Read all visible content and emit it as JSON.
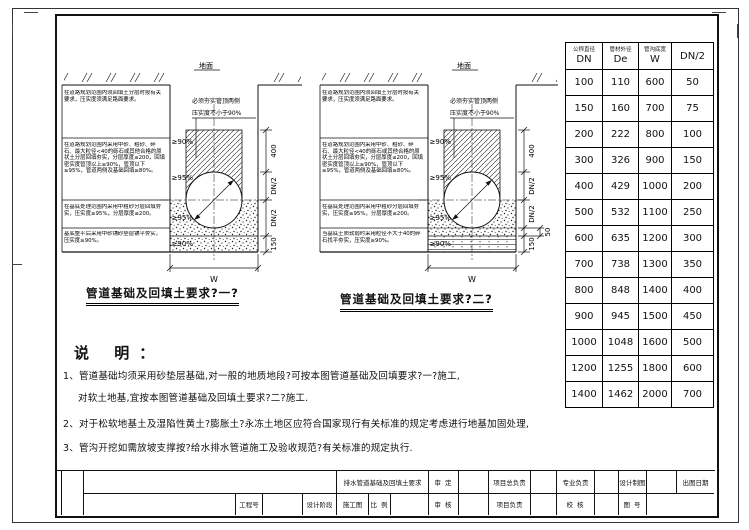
{
  "diagrams": {
    "left": {
      "ground_label": "地面",
      "title": "管道基础及回填土要求?一?",
      "width_label": "W",
      "ann1": "必须夯实管顶两侧",
      "ann2": "压实度不小于90%",
      "blocks": [
        "在道路规划范围内须回填土分层时按有关要求，压实度须满足路面要求。",
        "在道路规划范围内采用中砂、粗砂、碎石、最大粒径<40的砾石或其他合格的原状土分层回填夯实，分层厚度≤200，回填密实度管顶以上≥90%，管顶以下≥95%，管道两侧及基础回填≥80%。",
        "在基底处理范围内采用中粗砂分层回填夯实，压实度≥95%，分层厚度≤200。",
        "基底整平后采用中砂铺砂垫层铺平夯实，压实度≥90%。"
      ],
      "compaction": [
        "≥90%",
        "≥95%",
        "≥95%",
        "≥90%"
      ],
      "dims": [
        "400",
        "DN/2",
        "DN/2",
        "150"
      ]
    },
    "right": {
      "ground_label": "地面",
      "title": "管道基础及回填土要求?二?",
      "width_label": "W",
      "ann1": "必须夯实管顶两侧",
      "ann2": "压实度不小于90%",
      "blocks": [
        "在道路规划范围内须回填土分层时按有关要求，压实度须满足路面要求。",
        "在道路规划范围内采用中砂、粗砂、碎石、最大粒径<40的砾石或其他合格的原状土分层回填夯实，分层厚度≤200，回填密实度管顶以上≥90%，管顶以下≥95%，管道两侧及基础回填≥80%。",
        "在基底处理范围内采用中粗砂分层回填夯实，压实度≥95%，分层厚度≤200。",
        "当基底土质软弱时采用粒径不大于40的碎石找平夯实，压实度≥90%。"
      ],
      "compaction": [
        "≥90%",
        "≥95%",
        "≥95%",
        "≥90%"
      ],
      "dims": [
        "400",
        "DN/2",
        "DN/2",
        "50",
        "150"
      ]
    }
  },
  "table": {
    "headers": [
      {
        "cn": "公称直径",
        "sym": "DN"
      },
      {
        "cn": "管材外径",
        "sym": "De"
      },
      {
        "cn": "管沟底宽",
        "sym": "W"
      },
      {
        "cn": "",
        "sym": "DN/2"
      }
    ],
    "rows": [
      [
        "100",
        "110",
        "600",
        "50"
      ],
      [
        "150",
        "160",
        "700",
        "75"
      ],
      [
        "200",
        "222",
        "800",
        "100"
      ],
      [
        "300",
        "326",
        "900",
        "150"
      ],
      [
        "400",
        "429",
        "1000",
        "200"
      ],
      [
        "500",
        "532",
        "1100",
        "250"
      ],
      [
        "600",
        "635",
        "1200",
        "300"
      ],
      [
        "700",
        "738",
        "1300",
        "350"
      ],
      [
        "800",
        "848",
        "1400",
        "400"
      ],
      [
        "900",
        "945",
        "1500",
        "450"
      ],
      [
        "1000",
        "1048",
        "1600",
        "500"
      ],
      [
        "1200",
        "1255",
        "1800",
        "600"
      ],
      [
        "1400",
        "1462",
        "2000",
        "700"
      ]
    ]
  },
  "notes": {
    "heading": "说  明：",
    "line1": "1、管道基础均须采用砂垫层基础,对一般的地质地段?可按本图管道基础及回填要求?一?施工,",
    "line2": "对软土地基,宜按本图管道基础及回填土要求?二?施工.",
    "line3": "2、对于松软地基土及湿陷性黄土?膨胀土?永冻土地区应符合国家现行有关标准的规定考虑进行地基加固处理,",
    "line4": "3、管沟开挖如需放坡支撑按?给水排水管道施工及验收规范?有关标准的规定执行."
  },
  "titleblock": {
    "drawing_name": "排水管道基础及回填土要求",
    "shen_ding": "审 定",
    "xiangmu_zong": "项目总负责",
    "zhuanye": "专业负责",
    "sheji_zhitu": "设计制图",
    "chutu_riqi": "出图日期",
    "gongcheng_hao": "工程号",
    "sheji_jieduan": "设计阶段",
    "shigongtu": "施工图",
    "bili": "比 例",
    "shen_he": "审 核",
    "xiangmu_fuze": "项目负责",
    "jiao_he": "校 核",
    "tu_hao": "图 号"
  }
}
